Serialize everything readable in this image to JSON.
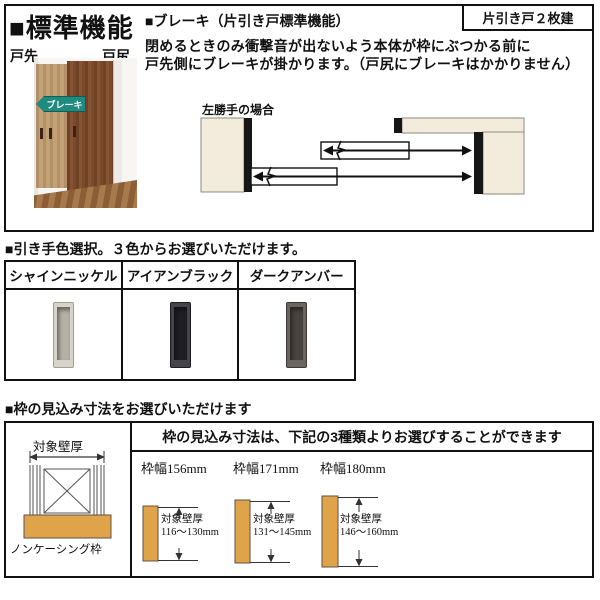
{
  "document": {
    "section_standard": {
      "heading": "■標準機能",
      "badge": "片引き戸２枚建",
      "brake_title": "■ブレーキ（片引き戸標準機能）",
      "brake_desc_line1": "閉めるときのみ衝撃音が出ないよう本体が枠にぶつかる前に",
      "brake_desc_line2": "戸先側にブレーキが掛かります。（戸尻にブレーキはかかりません）",
      "photo": {
        "door_front_label": "戸先",
        "door_rear_label": "戸尻",
        "brake_arrow_label": "ブレーキ"
      },
      "diagram_caption": "左勝手の場合"
    },
    "section_handle": {
      "heading": "■引き手色選択。３色からお選びいただけます。",
      "options": [
        {
          "name": "シャインニッケル",
          "color": "#d8d4cb"
        },
        {
          "name": "アイアンブラック",
          "color": "#45444b"
        },
        {
          "name": "ダークアンバー",
          "color": "#6b655f"
        }
      ]
    },
    "section_frame": {
      "heading": "■枠の見込み寸法をお選びいただけます",
      "left_diagram": {
        "wall_thickness_label": "対象壁厚",
        "frame_type_label": "ノンケーシング枠"
      },
      "header": "枠の見込み寸法は、下記の3種類よりお選びすることができます",
      "options": [
        {
          "frame_width": "枠幅156mm",
          "wall_label": "対象壁厚",
          "wall_range": "116〜130mm"
        },
        {
          "frame_width": "枠幅171mm",
          "wall_label": "対象壁厚",
          "wall_range": "131〜145mm"
        },
        {
          "frame_width": "枠幅180mm",
          "wall_label": "対象壁厚",
          "wall_range": "146〜160mm"
        }
      ]
    },
    "colors": {
      "brake_arrow_teal": "#1f8b80",
      "wall_fill_beige": "#f3ecdc",
      "frame_fill_orange": "#dfa349",
      "door_wood_brown": "#7a4a2b",
      "border_black": "#111111"
    }
  }
}
